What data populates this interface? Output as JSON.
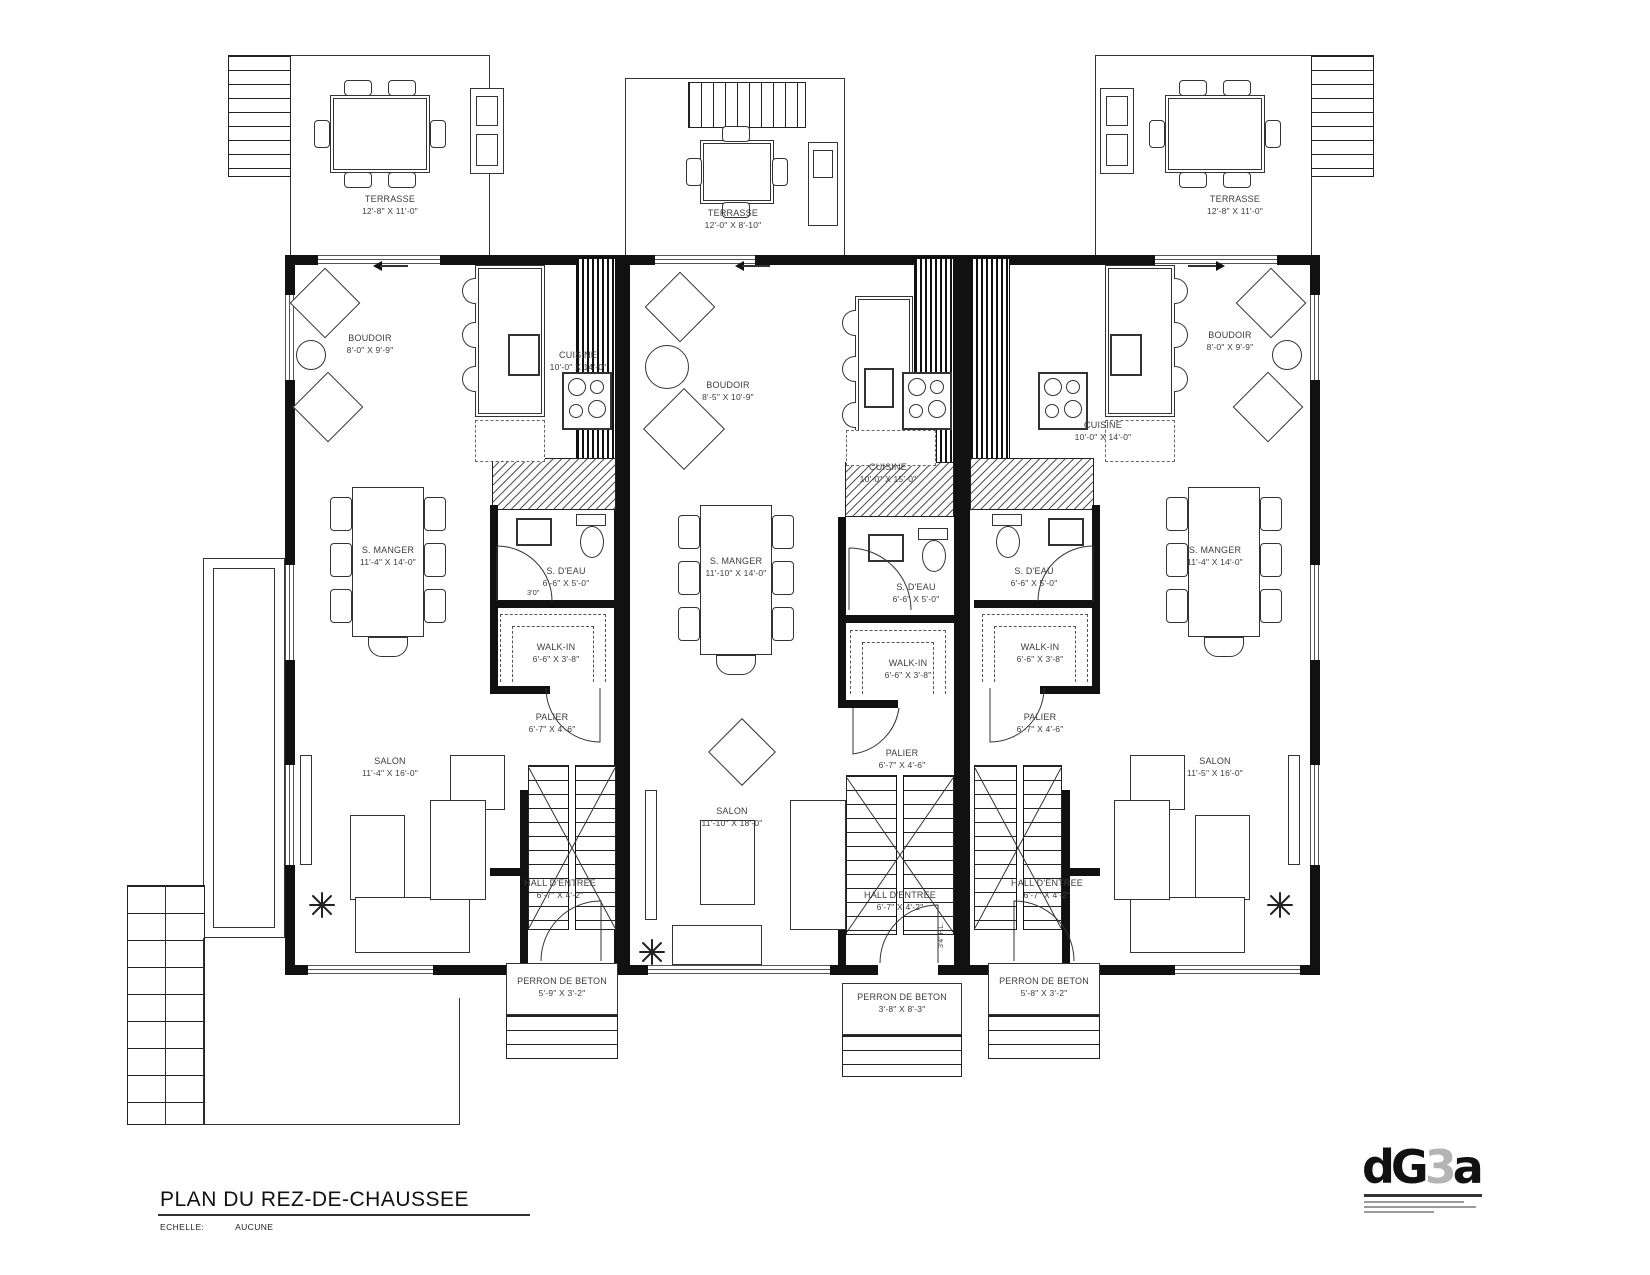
{
  "title": {
    "main": "PLAN DU REZ-DE-CHAUSSEE",
    "scale_label": "ECHELLE:",
    "scale_value": "AUCUNE"
  },
  "logo": {
    "part1": "dG",
    "part2": "3",
    "part3": "a"
  },
  "terraces": [
    {
      "name": "TERRASSE",
      "dims": "12'-8\" X 11'-0\""
    },
    {
      "name": "TERRASSE",
      "dims": "12'-0\" X 8'-10\""
    },
    {
      "name": "TERRASSE",
      "dims": "12'-8\" X 11'-0\""
    }
  ],
  "units": [
    {
      "boudoir": {
        "name": "BOUDOIR",
        "dims": "8'-0\" X 9'-9\""
      },
      "cuisine": {
        "name": "CUISINE",
        "dims": "10'-0\" X 14'-0\""
      },
      "s_manger": {
        "name": "S. MANGER",
        "dims": "11'-4\" X 14'-0\""
      },
      "s_deau": {
        "name": "S. D'EAU",
        "dims": "6'-6\" X 5'-0\""
      },
      "walk_in": {
        "name": "WALK-IN",
        "dims": "6'-6\" X 3'-8\""
      },
      "palier": {
        "name": "PALIER",
        "dims": "6'-7\" X 4'-6\""
      },
      "salon": {
        "name": "SALON",
        "dims": "11'-4\" X 16'-0\""
      },
      "hall": {
        "name": "HALL D'ENTREE",
        "dims": "6'-7\" X 4'-2\""
      },
      "perron": {
        "name": "PERRON DE BETON",
        "dims": "5'-9\" X 3'-2\""
      },
      "door_note": "3'0\""
    },
    {
      "boudoir": {
        "name": "BOUDOIR",
        "dims": "8'-5\" X 10'-9\""
      },
      "cuisine": {
        "name": "CUISINE",
        "dims": "10'-0\" X 15'-0\""
      },
      "s_manger": {
        "name": "S. MANGER",
        "dims": "11'-10\" X 14'-0\""
      },
      "s_deau": {
        "name": "S. D'EAU",
        "dims": "6'-6\" X 5'-0\""
      },
      "walk_in": {
        "name": "WALK-IN",
        "dims": "6'-6\" X 3'-8\""
      },
      "palier": {
        "name": "PALIER",
        "dims": "6'-7\" X 4'-6\""
      },
      "salon": {
        "name": "SALON",
        "dims": "11'-10\" X 18'-0\""
      },
      "hall": {
        "name": "HALL D'ENTREE",
        "dims": "6'-7\" X 4'-2\""
      },
      "perron": {
        "name": "PERRON DE BETON",
        "dims": "3'-8\" X 8'-3\""
      },
      "door_note": "3'4\" P.L."
    },
    {
      "boudoir": {
        "name": "BOUDOIR",
        "dims": "8'-0\" X 9'-9\""
      },
      "cuisine": {
        "name": "CUISINE",
        "dims": "10'-0\" X 14'-0\""
      },
      "s_manger": {
        "name": "S. MANGER",
        "dims": "11'-4\" X 14'-0\""
      },
      "s_deau": {
        "name": "S. D'EAU",
        "dims": "6'-6\" X 5'-0\""
      },
      "walk_in": {
        "name": "WALK-IN",
        "dims": "6'-6\" X 3'-8\""
      },
      "palier": {
        "name": "PALIER",
        "dims": "6'-7\" X 4'-6\""
      },
      "salon": {
        "name": "SALON",
        "dims": "11'-5\" X 16'-0\""
      },
      "hall": {
        "name": "HALL D'ENTREE",
        "dims": "6'-7\" X 4'-2\""
      },
      "perron": {
        "name": "PERRON DE BETON",
        "dims": "5'-8\" X 3'-2\""
      }
    }
  ]
}
